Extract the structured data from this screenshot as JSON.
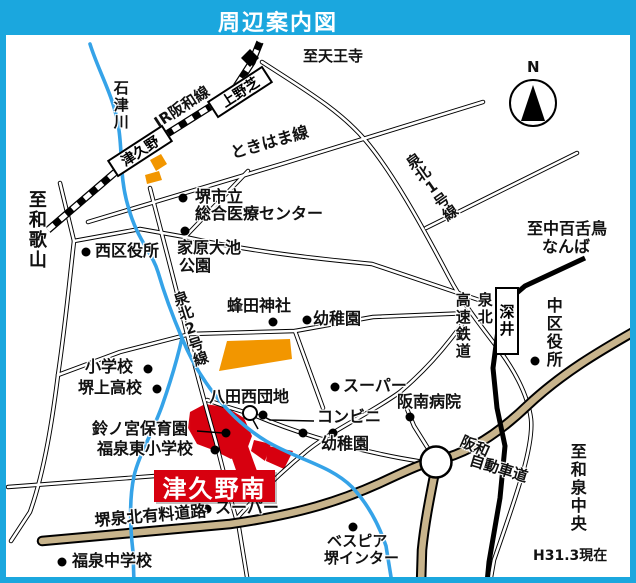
{
  "header": {
    "title": "周辺案内図"
  },
  "compass": {
    "label": "N"
  },
  "colors": {
    "frame_cyan": "#1BA7DE",
    "river_blue": "#35A3E8",
    "expressway_tan": "#C8B48C",
    "site_red": "#D7000F",
    "area_orange": "#F29600"
  },
  "river": {
    "ishizu": "石津川"
  },
  "railways": {
    "jr_hanwa": "JR阪和線",
    "senboku_rapid_col_right": "泉北",
    "senboku_rapid_col_left": "高速鉄道"
  },
  "stations": {
    "tsukuno": "津久野",
    "uenoshiba": "上野芝",
    "fukai": "深井"
  },
  "roads": {
    "tokihama": "ときはま線",
    "senboku_1": "泉北1号線",
    "senboku_2": "泉北2号線",
    "sakai_senboku_toll": "堺泉北有料道路",
    "hanwa_expwy_line1": "阪和",
    "hanwa_expwy_line2": "自動車道"
  },
  "directions": {
    "tennoji": "至天王寺",
    "wakayama": "至和歌山",
    "nakamozu_line1": "至中百舌鳥",
    "nakamozu_line2": "なんば",
    "izumi_chuo": "至和泉中央"
  },
  "places": {
    "sakai_medical_line1": "堺市立",
    "sakai_medical_line2": "総合医療センター",
    "nishi_ward_office": "西区役所",
    "ebara_park_line1": "家原大池",
    "ebara_park_line2": "公園",
    "hachita_shrine": "蜂田神社",
    "kindergarten_north": "幼稚園",
    "elementary_school": "小学校",
    "sakaigami_hs": "堺上高校",
    "hatta_nishi_danchi": "八田西団地",
    "super_north": "スーパー",
    "konbini": "コンビニ",
    "hannan_hospital": "阪南病院",
    "suzunomiya_nursery": "鈴ノ宮保育園",
    "fukusen_higashi_es": "福泉東小学校",
    "kindergarten_south": "幼稚園",
    "super_south": "スーパー",
    "fukusen_jhs": "福泉中学校",
    "bespia_line1": "ベスピア",
    "bespia_line2": "堺インター",
    "naka_ward_office": "中区役所"
  },
  "site": {
    "name": "津久野南"
  },
  "note": {
    "date": "H31.3現在"
  }
}
